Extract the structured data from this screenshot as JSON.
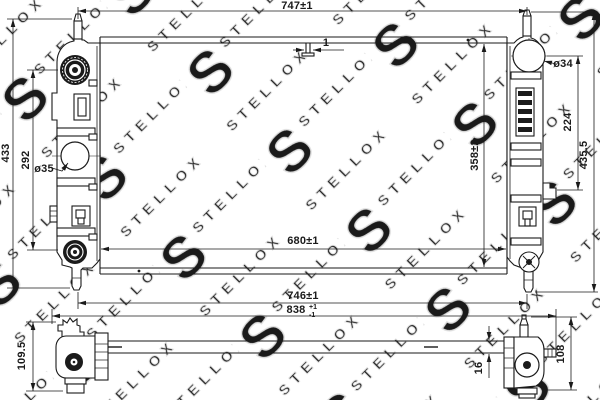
{
  "watermark": {
    "brand": "STELLOX",
    "letter": "S"
  },
  "colors": {
    "line": "#1a1a1a",
    "watermark_stroke": "#dcdcdc",
    "background": "#ffffff"
  },
  "views": {
    "front": {
      "dims": {
        "top_width": "747±1",
        "tab": "1",
        "left_overall": "433",
        "left_ports": "292",
        "left_port_dia": "ø35",
        "right_port_dia": "ø34",
        "right_ports": "224",
        "right_overall": "435.5",
        "core_height": "358±2",
        "core_width": "680±1",
        "pipes_width": "746±1",
        "overall_width": "838",
        "overall_tol_plus": "+1",
        "overall_tol_minus": "-1"
      }
    },
    "bottom": {
      "dims": {
        "left_height": "109.5",
        "thickness": "16",
        "right_height": "108"
      }
    }
  }
}
